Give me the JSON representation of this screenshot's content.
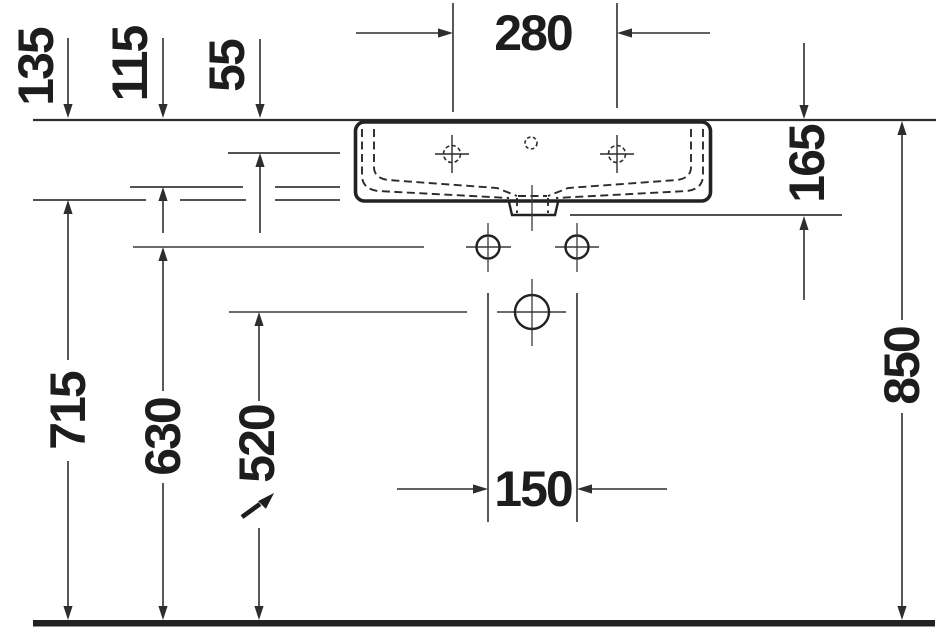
{
  "drawing": {
    "type": "technical-dimension-drawing",
    "subject": "wall-mounted washbasin, front elevation",
    "unit": "mm",
    "dims": {
      "faucet_spacing_280": "280",
      "rim_to_inner_edge_55": "55",
      "rim_to_basin_line_115": "115",
      "rim_to_bottom_line_135": "135",
      "basin_total_height_165": "165",
      "fixing_hole_spacing_150": "150",
      "floor_to_trap_center_520": "520",
      "floor_to_fixing_holes_630": "630",
      "floor_to_basin_bottom_715": "715",
      "floor_to_rim_850": "850"
    },
    "icons": {
      "diagonal_arrow": "↗"
    },
    "colors": {
      "thin_line": "#3a3a3a",
      "heavy_line": "#222222",
      "text": "#1d1d1d",
      "background": "#ffffff"
    }
  }
}
